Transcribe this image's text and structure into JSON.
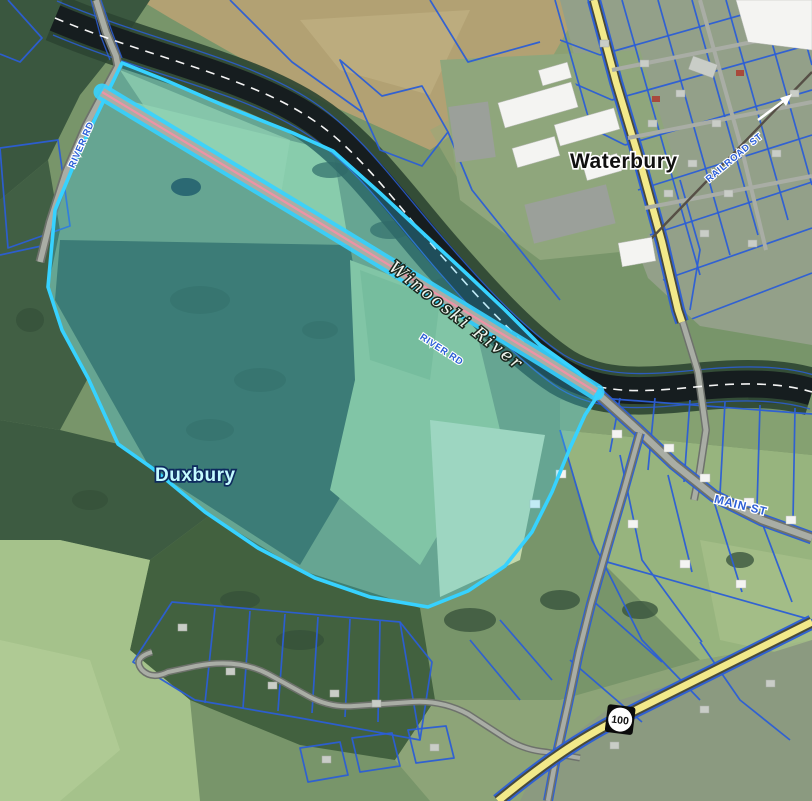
{
  "map": {
    "labels": {
      "town_north": "Waterbury",
      "town_south": "Duxbury",
      "river": "Winooski River",
      "main_st": "MAIN ST",
      "river_rd_west": "RIVER RD",
      "river_rd_east": "RIVER RD",
      "village_street": "RAILROAD ST",
      "route_shield": "100"
    },
    "features": {
      "highlighted_parcel": "selected parcel polygon straddling River Rd, Duxbury",
      "town_boundary": "white dashed line along Winooski River centerline",
      "route_shield_type": "Vermont state route marker"
    }
  },
  "colors": {
    "parcel_line": "#2b5ed6",
    "highlight": "#37d2ff",
    "highway": "#f2e98a",
    "town_boundary": "#ffffff",
    "route_centerline": "#ee93a6",
    "road_label": "#2b5ed6",
    "river_water": "#161d1f"
  }
}
